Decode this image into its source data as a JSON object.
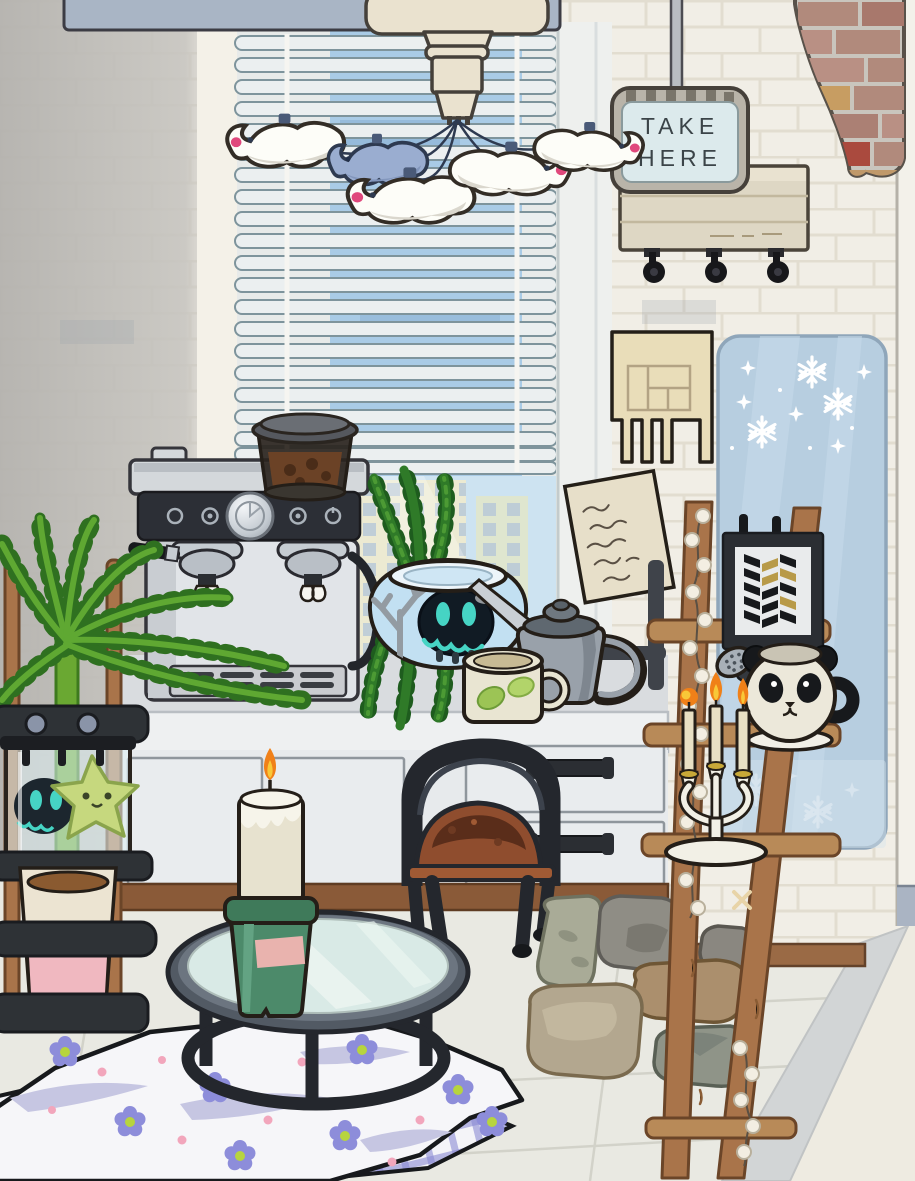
{
  "sign": {
    "line1": "TAKE",
    "line2": "HERE"
  },
  "objects": [
    "bird-mobile-ceiling-lamp",
    "window-blinds",
    "city-window-view",
    "take-here-sign",
    "supply-cart-with-casters",
    "exposed-brick-patch",
    "calendar-paper-cutout",
    "snowflake-board",
    "handwritten-note",
    "espresso-machine",
    "coffee-bean-hopper",
    "hanging-plant",
    "fish-bowl-with-ghost-creature",
    "gray-kettle",
    "leaf-mug",
    "kitchen-counter",
    "cabinet-doors",
    "drawer-unit",
    "wooden-chair-brown-seat",
    "black-plant-cart",
    "terrarium-with-star-creature",
    "potted-palm-plant",
    "wooden-ladder-shelf",
    "pearl-string-lights",
    "chevron-art-frame",
    "panda-mug",
    "shower-head",
    "white-candelabra-lit",
    "rocks-pile",
    "round-glass-coffee-table",
    "green-pot-candle",
    "flower-picnic-blanket",
    "plaid-blanket"
  ],
  "palette": {
    "wall": "#f1eee6",
    "wall_shadow": "#c7c5c0",
    "floor": "#e9e9e2",
    "blinds_sky": "#a9cbe6",
    "sign_panel": "#dceaec",
    "wood": "#a9744a",
    "brick_red": "#aa4a3e",
    "plant_green": "#5fa832",
    "flame_orange": "#f08018",
    "blanket_flower": "#8d8dda",
    "snow_board": "#b7cee0",
    "candle_pot_green": "#4c8a6a"
  }
}
